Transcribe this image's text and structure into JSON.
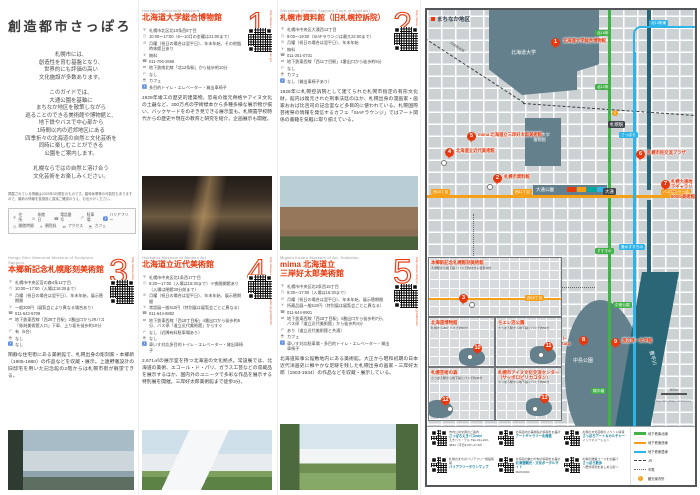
{
  "page": {
    "title": "創造都市さっぽろ",
    "intro_lines": [
      "札幌市には、",
      "創造性を育む基盤となり、",
      "世界的にも評価の高い",
      "文化施設が多数あります。",
      "",
      "このガイドでは、",
      "大通公園を基軸に",
      "まちなか地区を散策しながら",
      "巡ることのできる美術館や博物館と、",
      "地下鉄やバスで中心部から",
      "1時間以内の近郊地区にある",
      "四季折々の北海道の自然と文化芸術を",
      "同時に楽しむことができる",
      "公園をご案内します。",
      "",
      "札幌ならではの自然と溶け合う",
      "文化芸術をお楽しみください。"
    ],
    "note": "掲載されている情報は2023年3月現在のものです。臨時休業等の可能性もありますので、最新の情報を各施設に直接ご確認のうえ、お出かけください。",
    "icon_legend": {
      "row1": [
        {
          "icon": "addr",
          "label": "住所"
        },
        {
          "icon": "closed",
          "label": "休館日"
        },
        {
          "icon": "tel",
          "label": "電話番号"
        },
        {
          "icon": "park",
          "label": "駐車場"
        },
        {
          "icon": "bf",
          "label": "バリアフリー"
        }
      ],
      "row2": [
        {
          "icon": "time",
          "label": "開館時間"
        },
        {
          "icon": "fee",
          "label": "観覧料"
        },
        {
          "icon": "access",
          "label": "アクセス"
        },
        {
          "icon": "cafe",
          "label": "カフェ"
        }
      ]
    }
  },
  "entries": [
    {
      "no": "1",
      "en": "Hokkaido University Museum",
      "ja": "北海道大学総合博物館",
      "url": "http://www.museum.hokudai.ac.jp/",
      "details": [
        {
          "i": "addr",
          "t": "札幌市北区北10条西8丁目"
        },
        {
          "i": "time",
          "t": "10:00〜17:00（6〜10月の金曜は21:00まで）"
        },
        {
          "i": "closed",
          "t": "月曜（祝日の場合は翌平日）、年末年始、その他臨時休館日あり"
        },
        {
          "i": "fee",
          "t": "無料"
        },
        {
          "i": "tel",
          "t": "011-706-2658"
        },
        {
          "i": "access",
          "t": "地下鉄南北線「北12条駅」から徒歩約10分"
        },
        {
          "i": "park",
          "t": "なし"
        },
        {
          "i": "cafe",
          "t": "カフェ"
        },
        {
          "i": "bf",
          "t": "多目的トイレ・エレベーター・貸出車椅子"
        }
      ],
      "body": "1929年竣工の歴史的建築物。恐竜の復元骨格やアイヌ文化の土器など、300万点の学術標本から多種多様な展示物が揃い、バックヤードをのぞき見できる展示室も。札幌農学校時代からの歴史や現在の教育と研究を紹介。企画展示も開催。"
    },
    {
      "no": "2",
      "en": "Shiryokan (Former Sapporo Court of Appeals)",
      "ja": "札幌市資料館（旧札幌控訴院）",
      "url": "http://www.s-shiryokan.jp/",
      "details": [
        {
          "i": "addr",
          "t": "札幌市中央区大通西13丁目"
        },
        {
          "i": "time",
          "t": "9:00〜19:00（SIAFラウンジは最大22:00まで）"
        },
        {
          "i": "closed",
          "t": "月曜（祝日の場合は翌平日）、年末年始"
        },
        {
          "i": "fee",
          "t": "無料"
        },
        {
          "i": "tel",
          "t": "011-251-0731"
        },
        {
          "i": "access",
          "t": "地下鉄東西線「西11丁目駅」1番出口から徒歩約5分"
        },
        {
          "i": "park",
          "t": "なし"
        },
        {
          "i": "cafe",
          "t": "カフェ"
        },
        {
          "i": "bf",
          "t": "なし（貸出車椅子あり）"
        }
      ],
      "body": "1926年に札幌控訴院として建てられた札幌市指定の有形文化財。館内は復元された刑事法廷のほか、札幌出身の漫画家・画家おおば比呂司の記念室など多目的に使われている。札幌国際芸術祭の情報を発信するカフェ「SIAFラウンジ」ではアート関係の書籍を気軽に取り揃えている。"
    },
    {
      "no": "3",
      "en": "Hongo Shin Memorial Museum of Sculpture, Sapporo",
      "ja": "本郷新記念札幌彫刻美術館",
      "url": "http://www.hongoshin-smos.jp/",
      "details": [
        {
          "i": "addr",
          "t": "札幌市中央区宮の森4条12丁目"
        },
        {
          "i": "time",
          "t": "10:00〜17:00（入場は16:30まで）"
        },
        {
          "i": "closed",
          "t": "月曜（祝日の場合は翌平日）、年末年始、展示替期間"
        },
        {
          "i": "fee",
          "t": "一般300円（展覧会により異なる場合あり）"
        },
        {
          "i": "tel",
          "t": "011-642-5709"
        },
        {
          "i": "access",
          "t": "地下鉄東西線「西28丁目駅」2番出口からJRバス「彫刻美術館入口」下車、上り坂を徒歩約10分"
        },
        {
          "i": "park",
          "t": "有（5台）"
        },
        {
          "i": "cafe",
          "t": "なし"
        },
        {
          "i": "bf",
          "t": "なし"
        }
      ],
      "body": "閑静な住宅街にある美術館で、札幌出身の彫刻家・本郷新（1905-1980）の作品などを収蔵・展示。上遠野徹設計の旧邸宅を用いた記念館の2階からは札幌市街が眺望できる。"
    },
    {
      "no": "4",
      "en": "Hokkaido Museum of Modern Art",
      "ja": "北海道立近代美術館",
      "url": "http://www.dokyoi.pref.hokkaido.lg.jp/hk/knb/",
      "details": [
        {
          "i": "addr",
          "t": "札幌市中央区北1条西17丁目"
        },
        {
          "i": "time",
          "t": "9:30〜17:00（入場は16:30まで）※夜間開館あり（入場は閉館30分前まで）"
        },
        {
          "i": "closed",
          "t": "月曜（祝日の場合は翌平日）、年末年始、展示替期間"
        },
        {
          "i": "fee",
          "t": "常設展一般510円（特別展は展覧会ごとに異なる）"
        },
        {
          "i": "tel",
          "t": "011-644-6882"
        },
        {
          "i": "access",
          "t": "地下鉄東西線「西18丁目駅」4番出口から徒歩約5分、バス停「道立近代美術館」からすぐ"
        },
        {
          "i": "park",
          "t": "なし（近隣有料駐車場あり）"
        },
        {
          "i": "cafe",
          "t": "なし"
        },
        {
          "i": "bf",
          "t": "車いす対応多目的トイレ・エレベーター・貸出車椅子"
        }
      ],
      "body": "2,671㎡の展示室を持つ北海道の文化拠点。常設展では、北海道の美術、エコール・ド・パリ、ガラス工芸などの収蔵品を展示するほか、国内外のユニークで多彩な作品を展示する特別展を開催。三岸好太郎美術館まで徒歩3分。"
    },
    {
      "no": "5",
      "en": "Migishi Kotaro Museum of Art, Hokkaido",
      "ja": "mima 北海道立\n三岸好太郎美術館",
      "url": "http://www.dokyoi.pref.hokkaido.lg.jp/hk/mkb/",
      "details": [
        {
          "i": "addr",
          "t": "札幌市中央区北2条西15丁目"
        },
        {
          "i": "time",
          "t": "9:30〜17:00（入場は16:30まで）"
        },
        {
          "i": "closed",
          "t": "月曜（祝日の場合は翌平日）、年末年始、展示替期間"
        },
        {
          "i": "fee",
          "t": "所蔵品展一般510円（特別展は展覧会ごとに異なる）"
        },
        {
          "i": "tel",
          "t": "011-644-8901"
        },
        {
          "i": "access",
          "t": "地下鉄東西線「西18丁目駅」4番出口から徒歩約7分、バス停「道立近代美術館」から徒歩約4分"
        },
        {
          "i": "park",
          "t": "あり（道立近代美術館と共通）"
        },
        {
          "i": "cafe",
          "t": "カフェ"
        },
        {
          "i": "bf",
          "t": "車いす対応駐車場・多目的トイレ・エレベーター・貸出車椅子"
        }
      ],
      "body": "北海道知事公館敷地内にある美術館。大正から昭和初期の日本近代洋画史に鮮やかな足跡を残した札幌出身の画家・三岸好太郎（1903-1934）の作品などを収蔵・展示している。"
    }
  ],
  "map": {
    "district_label": "まちなか地区",
    "areas": {
      "university": "北海道大学",
      "botanic": "北海道大学\n植物園",
      "odori": "大通公園",
      "nakajima": "中島公園",
      "river": "豊平川",
      "jr_line": "JR函館本線"
    },
    "stations_dark": [
      "札幌駅",
      "大通"
    ],
    "stations_green": [
      "北18条",
      "北12条",
      "すすきの",
      "中島公園",
      "幌平橋"
    ],
    "stations_orange": [
      "西18丁目",
      "西11丁目",
      "バスセンター前"
    ],
    "stations_blue": [
      "北13条東",
      "さっぽろ",
      "豊水すすきの"
    ],
    "info_icon": "i",
    "markers": [
      {
        "n": "1",
        "label": "北海道大学総合博物館"
      },
      {
        "n": "2",
        "label": "札幌市資料館"
      },
      {
        "n": "4",
        "label": "北海道立近代美術館"
      },
      {
        "n": "5",
        "label": "mima 北海道立三岸好太郎美術館"
      },
      {
        "n": "6",
        "label": "札幌市民交流プラザ"
      },
      {
        "n": "7",
        "label": "札幌大通地下ギャラリー\n500m美術館"
      },
      {
        "n": "8",
        "label": "札幌\nコンサート\nホールKitara"
      },
      {
        "n": "9",
        "label": "渡辺淳一文学館"
      }
    ],
    "insets": [
      {
        "marker": "3",
        "title": "本郷新記念札幌彫刻美術館",
        "sub": "大通駅から地下鉄・バスで約15分＋徒歩10分",
        "station": "西28丁目"
      },
      {
        "marker": "10",
        "title": "北海道博物館",
        "sub": "札幌からJRとバスで約50分"
      },
      {
        "marker": "11",
        "title": "モエレ沼公園",
        "sub": "さっぽろ駅から地下鉄とバスで約50分"
      },
      {
        "marker": "12",
        "title": "札幌芸術の森",
        "sub": "さっぽろ駅から地下鉄とバスで約40分"
      },
      {
        "marker": "13",
        "title": "札幌市アイヌ文化交流センター\n（サッポロピリカコタン）",
        "sub": "さっぽろ駅から地下鉄とバスで約60分"
      }
    ],
    "scale": "500m",
    "credit": "© OpenStreetMap contributors",
    "legend": [
      {
        "type": "line",
        "color": "#43b149",
        "label": "地下鉄南北線"
      },
      {
        "type": "line",
        "color": "#f6a01a",
        "label": "地下鉄東西線"
      },
      {
        "type": "line",
        "color": "#2fb4e9",
        "label": "地下鉄東豊線"
      },
      {
        "type": "dash",
        "label": "JR"
      },
      {
        "type": "dot",
        "label": "市電"
      },
      {
        "type": "info",
        "label": "観光案内所"
      }
    ],
    "qr_links": [
      {
        "t": "市内公共交通のご案内",
        "m": "さっぽろえきバスnavi",
        "s": "えきバス・テル TEL.011-222-4894（平日9:00〜17:30）"
      },
      {
        "t": "北海道内の美術館の情報をお届け",
        "m": "アートギャラリー北海道",
        "s": ""
      },
      {
        "t": "札幌の文化芸術のイベント情報",
        "m": "さっぽろアート＆カルチャー",
        "s": "インフォメーション"
      },
      {
        "t": "札幌のまちのバリアフリー施設情報",
        "m": "バリアフリータウンマップ",
        "s": ""
      },
      {
        "t": "北海道の魅力や旬の情報をお届け",
        "m": "北海道観光・文化ポータルサイト",
        "s": "MAKOMA!"
      },
      {
        "t": "札幌の散策コースをお届け",
        "m": "さっぽろ散歩",
        "s": "〜野外彫刻を楽しめる街〜"
      }
    ]
  }
}
